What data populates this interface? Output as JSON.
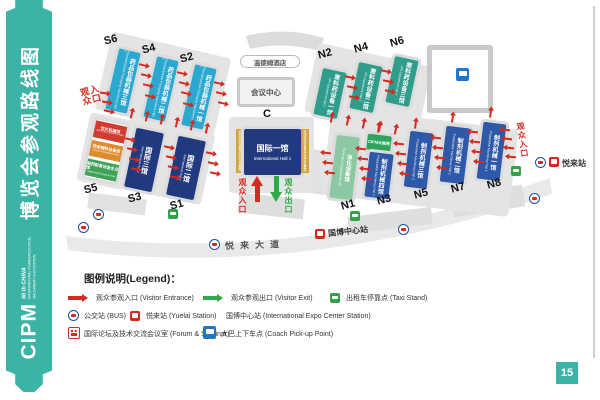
{
  "sidebar": {
    "title": "博览会参观路线图",
    "logo_text": "CIPM",
    "logo_line1": "66 th CHINA",
    "logo_line2": "INTERNATIONAL PHARMACEUTICAL",
    "logo_line3": "MACHINERY EXPOSITION"
  },
  "map": {
    "hotel_label": "温德姆酒店",
    "conference_label": "会议中心",
    "road_label": "悦来大道",
    "expo_station_label": "国博中心站",
    "yuelai_station_label": "悦来站",
    "entrance_label": "观众入口",
    "exit_label": "观众出口",
    "halls": {
      "s6": {
        "code": "S6",
        "cn": "药品包装机械三馆",
        "en": "Pharmaceutical Packaging Machinery Hall 3"
      },
      "s4": {
        "code": "S4",
        "cn": "药品包装机械二馆",
        "en": "Pharmaceutical Packaging Machinery Hall 2"
      },
      "s2": {
        "code": "S2",
        "cn": "药品包装机械一馆",
        "en": "Pharmaceutical Packaging Machinery Hall 1"
      },
      "s5": {
        "code": "S5",
        "segments": [
          {
            "cn": "饮片机械馆",
            "en": "Decoction Machinery Hall"
          },
          {
            "cn": "药用辅料设备馆",
            "en": "Excipient Equipment Hall"
          },
          {
            "cn": "制药配套设备企业馆",
            "en": "Supporting Equipment Hall"
          }
        ]
      },
      "s3": {
        "code": "S3",
        "cn": "国际三馆",
        "en": "International Hall 3"
      },
      "s1": {
        "code": "S1",
        "cn": "国际二馆",
        "en": "International Hall 2"
      },
      "c": {
        "code": "C",
        "cn": "国际一馆",
        "en": "International Hall 1",
        "side_label": "检测检验设备及实验室装备馆"
      },
      "n2": {
        "code": "N2",
        "cn": "原料药设备一馆",
        "en": "API Equipment Hall 1"
      },
      "n4": {
        "code": "N4",
        "cn": "原料药设备二馆",
        "en": "API Equipment Hall 2"
      },
      "n6": {
        "code": "N6",
        "cn": "原料药设备三馆",
        "en": "API Equipment Hall 3"
      },
      "n1": {
        "code": "N1",
        "cn": "净化设备馆",
        "en": "Purification Equipment Hall"
      },
      "n3": {
        "code": "N3",
        "cap": "CIPM大咖秀",
        "cn": "制剂机械四馆",
        "en": "Preparation Machinery Hall 4"
      },
      "n5": {
        "code": "N5",
        "cn": "制剂机械三馆",
        "en": "Preparation Machinery Hall 3"
      },
      "n7": {
        "code": "N7",
        "cn": "制剂机械二馆",
        "en": "Preparation Machinery Hall 2"
      },
      "n8": {
        "code": "N8",
        "cn": "制剂机械一馆",
        "en": "Preparation Machinery Hall 1"
      }
    }
  },
  "legend": {
    "title": "图例说明(Legend)：",
    "entrance": "观众参观入口 (Visitor Entrance)",
    "exit": "观众参观出口 (Visitor Exit)",
    "taxi": "出租车停靠点 (Taxi Stand)",
    "bus": "公交站 (BUS)",
    "yuelai": "悦来站 (Yuelai Station)",
    "expo": "国博中心站 (International Expo Center Station)",
    "forum": "国际论坛及技术交流会议室 (Forum & Seminar)",
    "coach": "大巴上下车点 (Coach Pick-up Point)"
  },
  "page_number": "15",
  "colors": {
    "teal": "#3bb4a6",
    "red": "#d42a1f",
    "green": "#2fa84a",
    "cyan": "#2ba8cf",
    "navy": "#21397f",
    "blue": "#2d59a8",
    "tealgreen": "#2f9c8c",
    "lightgreen": "#8cc9a2",
    "gold": "#d2a43c"
  }
}
